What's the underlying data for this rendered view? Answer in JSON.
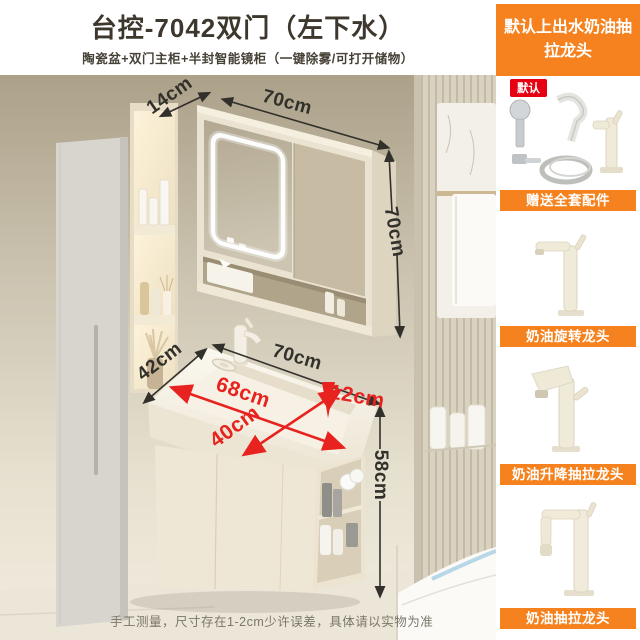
{
  "header": {
    "title": "台控-7042双门（左下水）",
    "subtitle": "陶瓷盆+双门主柜+半封智能镜柜（一键除雾/可打开储物）"
  },
  "sidebar": {
    "banner": "默认上出水奶油抽拉龙头",
    "default_badge": "默认",
    "sections": [
      {
        "label": "赠送全套配件",
        "image": "drain-kit-and-cream-faucet"
      },
      {
        "label": "奶油旋转龙头",
        "image": "cream-rotating-faucet"
      },
      {
        "label": "奶油升降抽拉龙头",
        "image": "cream-lift-pullout-faucet"
      },
      {
        "label": "奶油抽拉龙头",
        "image": "cream-pullout-faucet"
      }
    ]
  },
  "measurements": {
    "mirror_depth": "14cm",
    "mirror_width": "70cm",
    "mirror_height": "70cm",
    "counter_depth": "42cm",
    "counter_width": "70cm",
    "basin_length": "68cm",
    "basin_depth": "12cm",
    "basin_width": "40cm",
    "cabinet_height": "58cm"
  },
  "footer": {
    "disclaimer": "手工测量，尺寸存在1-2cm少许误差，具体请以实物为准"
  },
  "colors": {
    "accent_orange": "#f5821e",
    "badge_red": "#e60012",
    "dimension_red": "#e8231f",
    "dimension_black": "#32302b"
  }
}
